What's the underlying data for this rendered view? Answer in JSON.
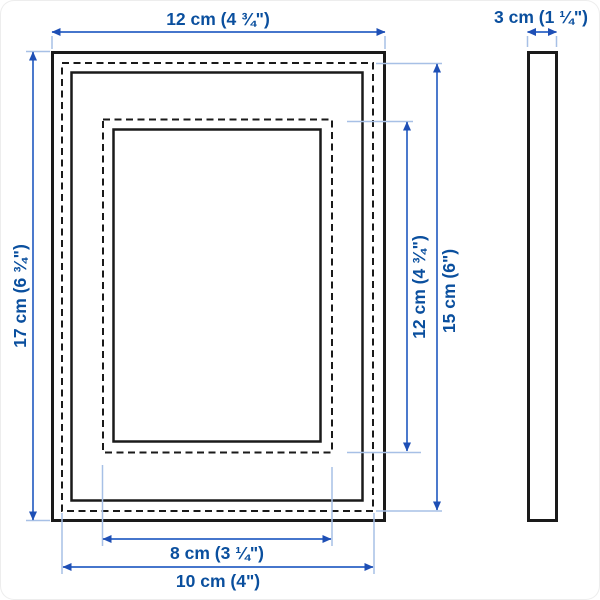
{
  "dimensions": {
    "outer_width": "12 cm (4 ¾\")",
    "outer_height": "17 cm (6 ¾\")",
    "depth": "3 cm (1 ¼\")",
    "picture_width": "10 cm (4\")",
    "picture_height": "15 cm (6\")",
    "opening_width": "8 cm (3 ¼\")",
    "opening_height": "12 cm (4 ¾\")"
  },
  "colors": {
    "dimension_text": "#0a4f9e",
    "dimension_line": "#2c62c4",
    "extension_line": "#a7c0e6",
    "drawing_line": "#1a1a1a",
    "background": "#ffffff"
  }
}
